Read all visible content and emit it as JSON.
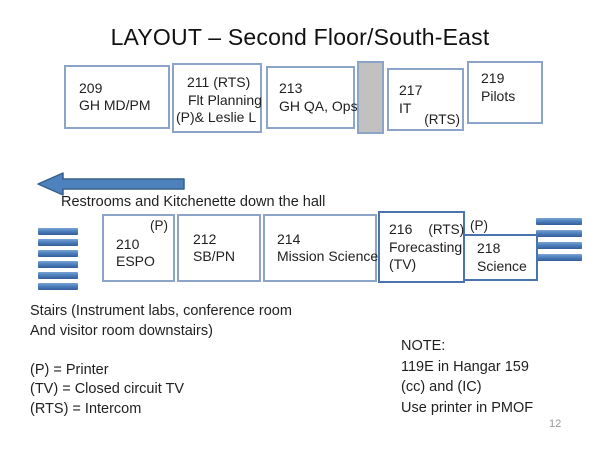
{
  "slide": {
    "title": "LAYOUT – Second Floor/South-East",
    "page_number": "12"
  },
  "colors": {
    "room_border": "#8da4c9",
    "dark_room_border": "#4a74ae",
    "gray_block_fill": "#c1c1c1",
    "arrow_fill": "#4f81bd",
    "arrow_stroke": "#36618e",
    "stairs_fill": "#4f81bd",
    "text": "#1f1f1f",
    "page_number_color": "#9a9a9a"
  },
  "icons": {
    "left_arrow": "left-arrow",
    "stairs": "stairs-bars"
  },
  "rooms_top": [
    {
      "line1": "209",
      "line2": "GH MD/PM"
    },
    {
      "line1": "211 (RTS)",
      "line2": "Flt Planning",
      "line3": "(P)& Leslie L"
    },
    {
      "line1": "213",
      "line2": "GH QA, Ops"
    },
    {
      "line1": "217",
      "line2": "IT",
      "corner": "(RTS)"
    },
    {
      "line1": "219",
      "line2": "Pilots"
    }
  ],
  "hall": {
    "label": "Restrooms and Kitchenette down the hall"
  },
  "rooms_bottom": [
    {
      "corner": "(P)",
      "line1": "210",
      "line2": "ESPO"
    },
    {
      "line1": "212",
      "line2": "SB/PN"
    },
    {
      "line1": "214",
      "line2": "Mission Science"
    },
    {
      "number": "216",
      "tag": "(RTS)",
      "line2": "Forecasting",
      "line3": "(TV)"
    },
    {
      "top_label": "(P)",
      "line1": "218",
      "line2": "Science"
    }
  ],
  "legend": {
    "lines": [
      "Stairs (Instrument labs, conference room",
      "And visitor room downstairs)",
      "",
      "(P) = Printer",
      "(TV) = Closed circuit TV",
      "(RTS) = Intercom"
    ]
  },
  "note": {
    "lines": [
      "NOTE:",
      "119E in Hangar 159",
      "(cc) and (IC)",
      "Use printer in PMOF"
    ]
  }
}
